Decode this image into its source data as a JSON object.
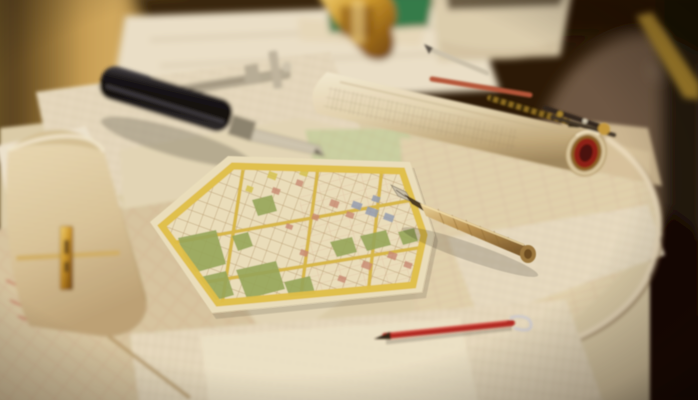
{
  "scene": {
    "subject": "drafting-desk-with-city-maps-and-drawing-tools",
    "style": "photograph, shallow depth of field, warm amber light"
  },
  "colors": {
    "background_dark": "#241505",
    "window_amber": "#c9a258",
    "desk_wood": "#4a2c16",
    "paper_cream": "#ddd0ae",
    "paper_white": "#ece4cf",
    "map_base": "#ece3c2",
    "map_border_yellow": "#e2c24a",
    "map_park_green": "#94a85c",
    "map_road_yellow": "#d9b945",
    "map_block_red": "#c98a76",
    "map_block_blue": "#93a0b8",
    "tube_paper": "#e6d9b6",
    "tube_rim_red": "#8c1e14",
    "tool_black": "#121214",
    "metal_silver": "#cfc9b6",
    "brass_gold": "#c49a3c",
    "pen_barrel": "#bf9a58",
    "red_pen": "#b22622",
    "green_book": "#2e7c4b",
    "pencil_yellow": "#a8862e"
  },
  "objects": [
    "window-light",
    "desk-surface",
    "city-street-map",
    "rolled-blueprint",
    "fountain-pen",
    "red-ballpoint-pen",
    "sliding-caliper",
    "marking-gauge",
    "brass-square-tool",
    "curled-ledger-sheet",
    "green-book",
    "thick-book",
    "brass-ornament",
    "silver-pencil",
    "striped-pencil",
    "divider-compass",
    "yellow-pencil",
    "map-sheets",
    "technical-drawings"
  ]
}
